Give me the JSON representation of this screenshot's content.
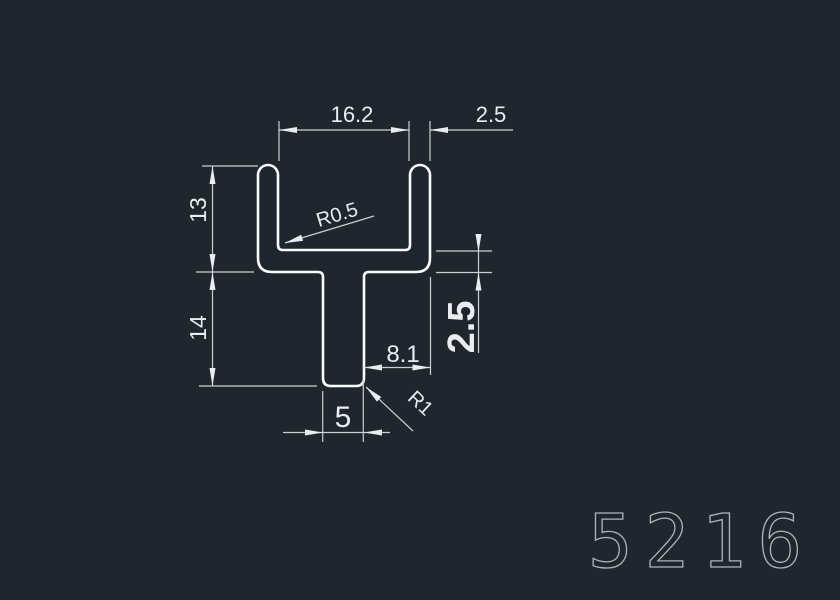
{
  "drawing": {
    "part_number": "5216",
    "dimensions": {
      "channel_inner_width": "16.2",
      "leg_thickness": "2.5",
      "channel_depth": "13",
      "stem_depth": "14",
      "web_thickness": "2.5",
      "stem_to_edge": "8.1",
      "stem_width": "5",
      "inner_fillet_radius": "R0.5",
      "stem_corner_radius": "R1"
    },
    "colors": {
      "background": "#20262e",
      "profile_stroke": "#f8fafb",
      "dimension_lines": "#c9cfd4",
      "dimension_text": "#e9edf0",
      "part_number_stroke": "#aeb4bb"
    }
  }
}
